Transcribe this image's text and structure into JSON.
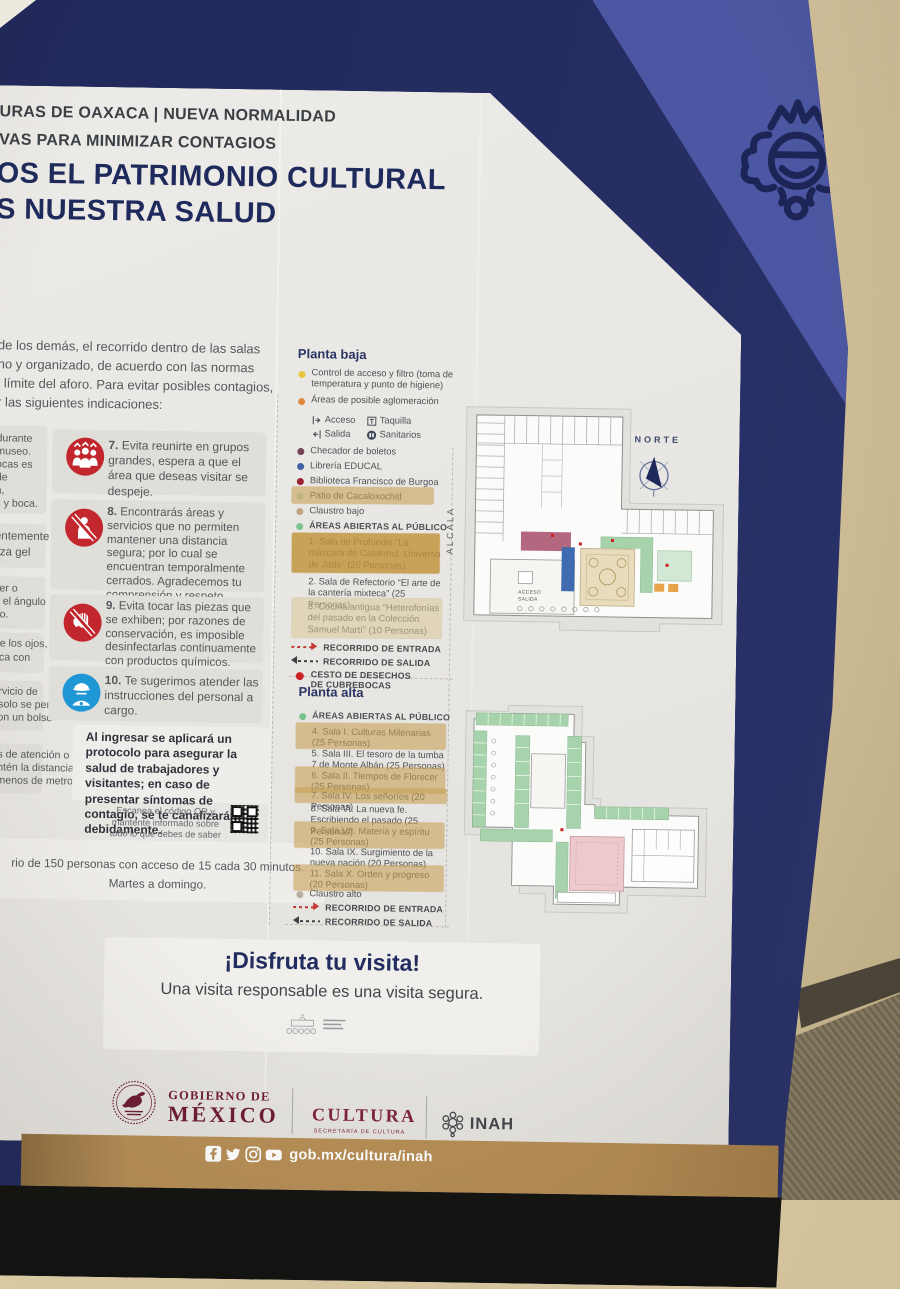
{
  "board": {
    "header": {
      "kicker1": "URAS DE OAXACA | NUEVA NORMALIDAD",
      "kicker2": "VAS PARA MINIMIZAR CONTAGIOS",
      "title_line1": "OS EL PATRIMONIO CULTURAL",
      "title_line2": "S NUESTRA SALUD"
    },
    "intro": {
      "line1": "de los demás, el recorrido dentro de las salas",
      "line2": "no y organizado, de acuerdo con las normas",
      "line3": "l límite del aforo. Para evitar posibles contagios,",
      "line4": "r las siguientes indicaciones:"
    },
    "left_fragments": {
      "card1": {
        "l1": "durante",
        "l2": "museo.",
        "l3": "ocas es",
        "l4": "de",
        "l5": "a,",
        "l6": "z y boca."
      },
      "card2": {
        "l1": "entemente",
        "l2": "liza gel"
      },
      "card3": {
        "l1": "ser o",
        "l2": "a el ángulo",
        "l3": "do."
      },
      "card4": {
        "l1": "rte los ojos,",
        "l2": "oca con"
      },
      "card5": {
        "l1": "ervicio de",
        "l2": ", solo se permite",
        "l3": "con un bolso"
      },
      "card6": {
        "l1": "as de atención o",
        "l2": "antén la distancia",
        "l3": "l menos de metro"
      }
    },
    "instructions": {
      "i7": {
        "num": "7.",
        "text": "Evita reunirte en grupos grandes, espera a que el área que deseas visitar se despeje."
      },
      "i8": {
        "num": "8.",
        "text": "Encontrarás áreas y servicios que no permiten mantener una distancia segura; por lo cual se encuentran temporalmente cerrados. Agradecemos tu comprensión y respeto."
      },
      "i9": {
        "num": "9.",
        "text": "Evita tocar las piezas que se exhiben; por razones de conservación, es imposible desinfectarlas continuamente con productos químicos."
      },
      "i10": {
        "num": "10.",
        "text": "Te sugerimos atender las instrucciones del personal a cargo."
      }
    },
    "protocol": "Al ingresar se aplicará un protocolo para asegurar la salud de trabajadores y visitantes; en caso de presentar síntomas de contagio, se te canalizará debidamente.",
    "qr_note": "Escanea el código QR y mantente informado sobre todo lo que debes de saber sobre la COVID-19.",
    "capacity": {
      "line1": "rio de 150 personas con acceso de 15 cada 30 minutos.",
      "line2": "Martes a domingo."
    },
    "planta_baja": {
      "title": "Planta baja",
      "control": "Control de acceso y filtro (toma de temperatura y punto de higiene)",
      "aglomeracion": "Áreas de posible aglomeración",
      "acceso": "Acceso",
      "taquilla": "Taquilla",
      "salida": "Salida",
      "sanitarios": "Sanitarios",
      "checador": "Checador de boletos",
      "libreria": "Librería EDUCAL",
      "biblioteca": "Biblioteca Francisco de Burgoa",
      "patio": "Patio de Cacaloxochitl",
      "claustro": "Claustro bajo",
      "areas_abiertas": "ÁREAS ABIERTAS AL PÚBLICO",
      "sala1": "1. Sala de Profundis “La máscara de Calakmul. Universo de Jade” (20 Personas)",
      "sala2": "2. Sala de Refectorio “El arte de la cantería mixteca” (25 Personas)",
      "sala3": "3. Cocina antigua “Heterofonías del pasado en la Colección Samuel Martí” (10 Personas)",
      "entrada": "RECORRIDO DE ENTRADA",
      "salida_r": "RECORRIDO DE SALIDA",
      "cesto": "CESTO DE DESECHOS DE CUBREBOCAS"
    },
    "planta_alta": {
      "title": "Planta alta",
      "areas_abiertas": "ÁREAS ABIERTAS AL PÚBLICO",
      "sala4": "4. Sala I. Culturas Milenarias (25 Personas)",
      "sala5": "5. Sala III. El tesoro de la tumba 7 de Monte Albán (25 Personas)",
      "sala6": "6. Sala II. Tiempos de Florecer (25 Personas)",
      "sala7": "7. Sala IV. Los señoríos (20 Personas)",
      "sala8": "8. Sala VI. La nueva fe. Escribiendo el pasado (25 Personas)",
      "sala9": "9. Sala VII. Materia y espíritu (25 Personas)",
      "sala10": "10. Sala IX. Surgimiento de la nueva nación (20 Personas)",
      "sala11": "11. Sala X. Orden y progreso (20 Personas)",
      "claustro": "Claustro alto",
      "entrada": "RECORRIDO DE ENTRADA",
      "salida_r": "RECORRIDO DE SALIDA"
    },
    "maps": {
      "norte": "NORTE",
      "alcala": "ALCALA",
      "acceso": "ACCESO",
      "salida": "SALIDA"
    },
    "disfruta": {
      "title": "¡Disfruta tu visita!",
      "subtitle": "Una visita responsable es una visita segura."
    },
    "footer": {
      "gov_line1": "GOBIERNO DE",
      "gov_line2": "MÉXICO",
      "cultura": "CULTURA",
      "cultura_sub": "SECRETARÍA DE CULTURA",
      "inah": "INAH",
      "url": "gob.mx/cultura/inah"
    }
  },
  "colors": {
    "navy": "#232b5d",
    "stripe_blue": "#4c57a4",
    "panel": "#eae8e4",
    "alert_red": "#c1272d",
    "staff_blue": "#1f97d4",
    "gold_bar": "#b48c55",
    "gov_maroon": "#6e1d33",
    "tape": "#c79f52"
  }
}
